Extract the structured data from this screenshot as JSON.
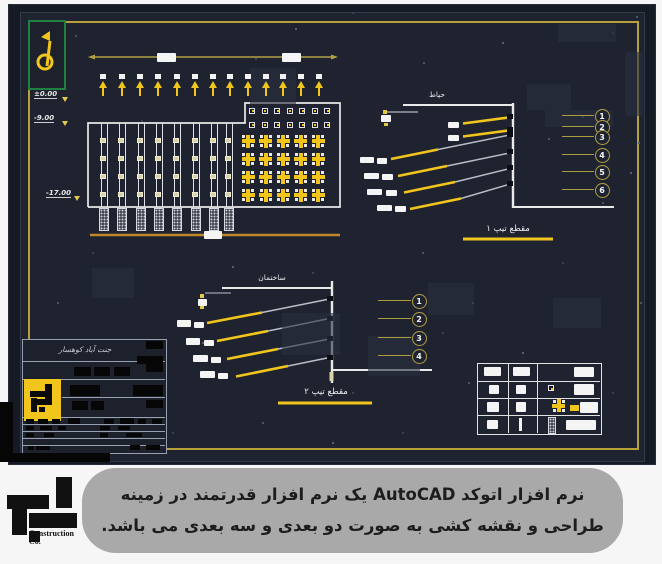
{
  "caption": {
    "line1": "نرم افزار اتوکد AutoCAD یک نرم افزار قدرتمند در زمینه",
    "line2": "طراحی و نقشه کشی به صورت دو بعدی و سه بعدی می باشد."
  },
  "logo": {
    "line1": "Istasazeh",
    "line2": "Construction",
    "line3": "Co."
  },
  "drawing": {
    "elevations": [
      "±0.00",
      "-9.00",
      "-17.00"
    ],
    "section1": {
      "title": "حیاط",
      "label": "مقطع تیپ ۱",
      "callouts": [
        "1",
        "2",
        "3",
        "4",
        "5",
        "6"
      ]
    },
    "section2": {
      "title": "ساختمان",
      "label": "مقطع تیپ ۲",
      "callouts": [
        "1",
        "2",
        "3",
        "4"
      ]
    },
    "titleblock": {
      "header": "جنت آباد کوهسار"
    },
    "colors": {
      "yellow": "#f2c51d",
      "olive": "#b3a043",
      "green": "#1f8040",
      "orange": "#c0882b"
    }
  }
}
